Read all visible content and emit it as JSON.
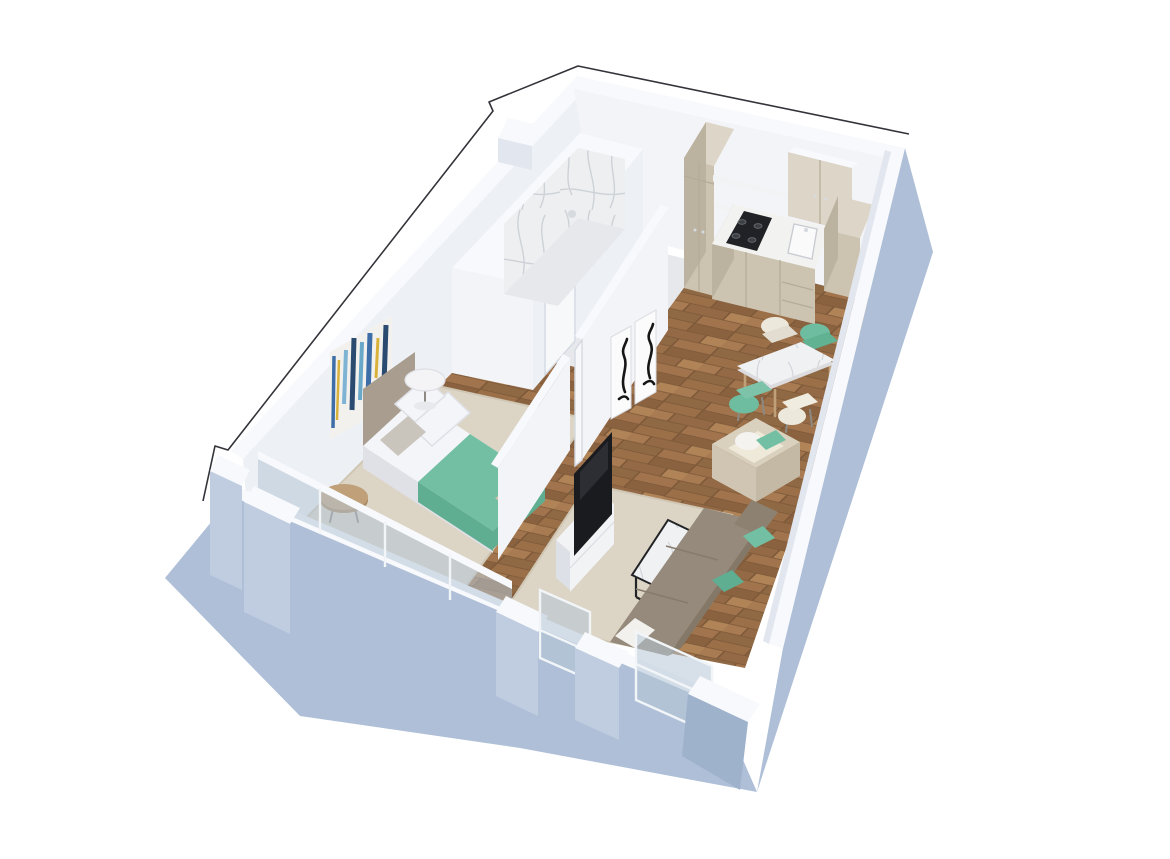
{
  "scene": {
    "title": "3D isometric cutaway floor plan of a one-bedroom apartment",
    "view": "isometric bird's-eye cutaway render",
    "background": "#ffffff"
  },
  "palette": {
    "background": "#ffffff",
    "outline": "#33343a",
    "wallTop": "#f7f9fc",
    "wallInner": "#edf0f5",
    "wallInnerLit": "#f3f4f7",
    "wallInnerShade": "#e2e6ee",
    "wallOuter": "#aebfd7",
    "wallOuterLight": "#c0cde0",
    "wallOuterDark": "#9fb2cc",
    "bathFloor": "#e6e8ec",
    "rug": "#dcd4c5",
    "rugBorder": "#cfc6b4",
    "teal": "#72bfa3",
    "tealDark": "#5fae92",
    "softWhite": "#f2f1ee",
    "bedWhite": "#f4f5f8",
    "bedShadow": "#e0e1e7",
    "headboard": "#a89d8e",
    "cabinet": "#cdc3b1",
    "cabinetLight": "#ddd6c8",
    "cabinetDark": "#bcb2a0",
    "counter": "#f2f2f0",
    "hob": "#202226",
    "burner": "#3c3f44",
    "sofa": "#958a7b",
    "sofaDark": "#847968",
    "armchair": "#d9d0be",
    "armchairSeat": "#efe9da",
    "glass": "#b7c6d6",
    "glassFrame": "#f2f5f8",
    "woodFurniture": "#c0a078",
    "woodFurnitureDark": "#a8885f",
    "legDark": "#8d8a84",
    "tv": "#1a1b1e",
    "consoleWhite": "#f2f3f5",
    "consoleSide": "#dde0e6",
    "seam": "#b6ab97",
    "seamLight": "#d9dde3",
    "printMat": "#fbfbfc",
    "printEdge": "#d8dbe0",
    "printInk": "#161616",
    "door": "#f6f8fa",
    "doorFrame": "#d5dae2",
    "chrome": "#d7dadf",
    "frameBlack": "#222326",
    "marbleBase": "#edeff1",
    "marbleVein": "#c6cad1",
    "floorPlankA": "#9b6f48",
    "floorPlankB": "#8a6240",
    "floorPlankC": "#a87b52",
    "floorPlankD": "#946a46",
    "floorPlankE": "#b08457",
    "floorGap": "#7e5a3a",
    "artNavy": "#2b4a6f",
    "artBlue": "#3d6ea8",
    "artSky": "#7fb3d3",
    "artGold": "#d9b23c",
    "artTeal": "#69a8c9"
  },
  "rooms": [
    {
      "name": "bedroom",
      "furniture": [
        "double bed with white bedding",
        "teal throw blanket",
        "upholstered headboard",
        "white pillows",
        "round white pedestal side table",
        "round wooden side table",
        "abstract canvas artwork",
        "beige area rug",
        "floor-to-ceiling glass windows"
      ]
    },
    {
      "name": "bathroom",
      "furniture": [
        "marble-clad walk-in shower",
        "shower head",
        "white partition walls",
        "bathroom door"
      ]
    },
    {
      "name": "kitchen",
      "furniture": [
        "tall pantry cabinet",
        "two-door wall cabinet",
        "open shelves",
        "white countertop",
        "gas hob with four burners",
        "inset sink",
        "base cabinets with drawers",
        "corner cabinet column",
        "entry door"
      ]
    },
    {
      "name": "dining-area",
      "furniture": [
        "marble-top dining table",
        "teal dining chair",
        "teal dining chair",
        "cream dining chair",
        "cream dining chair"
      ]
    },
    {
      "name": "living-room",
      "furniture": [
        "taupe sofa",
        "teal accent cushions",
        "white accent cushion",
        "cube armchair with white and teal pillows",
        "marble coffee table with black frame",
        "flat-screen TV",
        "white media console",
        "beige area rug",
        "two framed abstract prints",
        "recessed front windows"
      ]
    },
    {
      "name": "corridor",
      "furniture": [
        "gallery wall with two framed prints",
        "bedroom doorway"
      ]
    }
  ],
  "materials": [
    "white plaster walls",
    "powder-blue exterior walls",
    "oak parquet flooring",
    "white marble",
    "tinted glazing"
  ]
}
